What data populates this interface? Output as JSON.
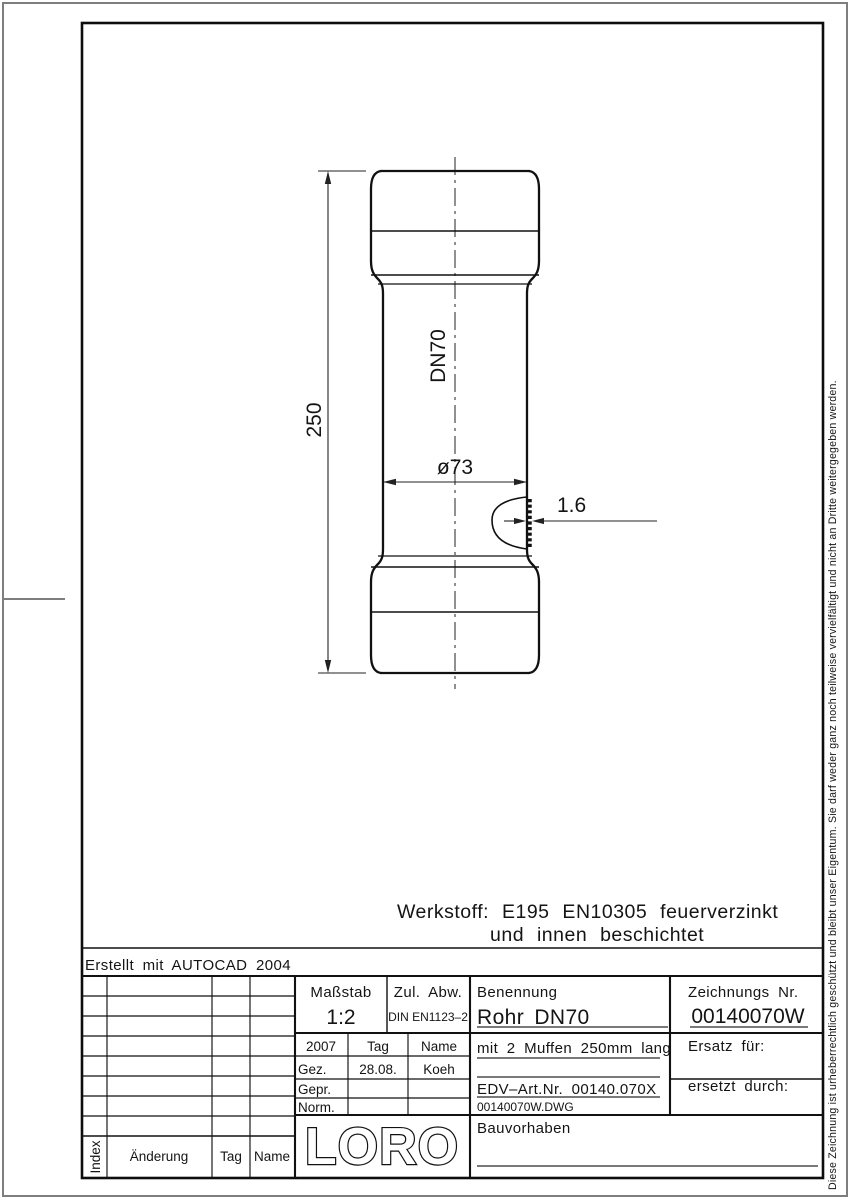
{
  "sheet": {
    "created_with": "Erstellt mit AUTOCAD 2004",
    "copyright_vertical": "Diese Zeichnung ist urheberrechtlich geschützt und bleibt unser Eigentum. Sie darf weder ganz noch teilweise vervielfältigt und nicht an Dritte weitergegeben werden."
  },
  "drawing": {
    "material_line1": "Werkstoff: E195 EN10305 feuerverzinkt",
    "material_line2": "und innen beschichtet",
    "dim_length": "250",
    "dim_nominal": "DN70",
    "dim_diameter": "ø73",
    "dim_wall": "1.6"
  },
  "title_block": {
    "masstab": {
      "label": "Maßstab",
      "value": "1:2"
    },
    "zul_abw": {
      "label": "Zul. Abw.",
      "value": "DIN EN1123–2"
    },
    "benennung": {
      "label": "Benennung",
      "value": "Rohr DN70"
    },
    "zeichnung": {
      "label": "Zeichnungs Nr.",
      "value": "00140070W"
    },
    "approval": {
      "year": "2007",
      "tag_header": "Tag",
      "name_header": "Name",
      "gez_label": "Gez.",
      "gez_tag": "28.08.",
      "gez_name": "Koeh",
      "gepr_label": "Gepr.",
      "norm_label": "Norm."
    },
    "description": "mit 2 Muffen 250mm lang",
    "edv_art_nr": "EDV–Art.Nr. 00140.070X",
    "dwg_file": "00140070W.DWG",
    "ersatz_fuer": "Ersatz für:",
    "ersetzt_durch": "ersetzt durch:",
    "bauvorhaben": "Bauvorhaben",
    "logo": "LORO",
    "revision": {
      "index": "Index",
      "aenderung": "Änderung",
      "tag": "Tag",
      "name": "Name"
    }
  },
  "colors": {
    "line": "#141414",
    "border_gray": "#7e7e7e",
    "background": "#ffffff"
  }
}
